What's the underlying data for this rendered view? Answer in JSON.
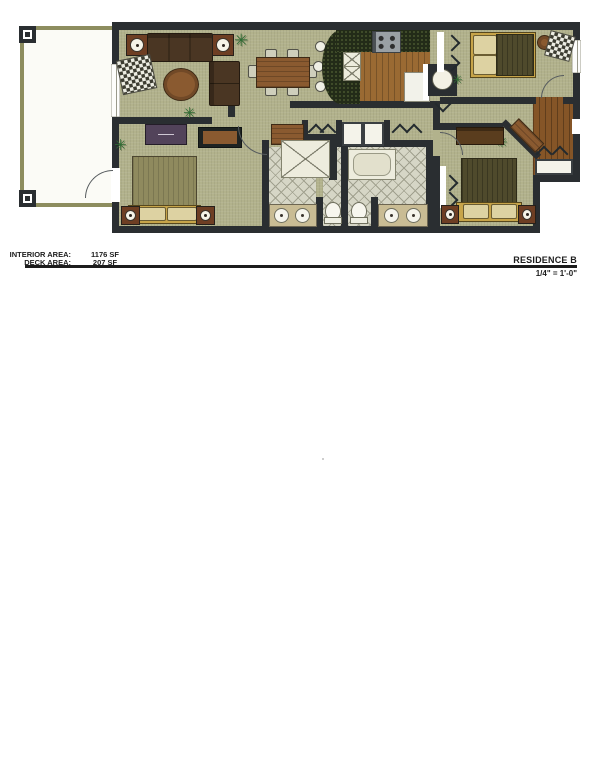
{
  "sheet": {
    "areas": [
      {
        "label": "INTERIOR AREA:",
        "value": "1176 SF"
      },
      {
        "label": "DECK AREA:",
        "value": "207 SF"
      }
    ],
    "title": "RESIDENCE B",
    "scale": "1/4\" = 1'-0\""
  },
  "icons": {
    "plant": "✳"
  },
  "colors": {
    "wall": "#2a2e31",
    "floor": "#b2b28c",
    "deckTrim": "#8d8d5f",
    "deckFloor": "#fbfbf6",
    "wood": "#855527",
    "woodLight": "#9a6a33",
    "counter": "#232b18",
    "tile": "#d6d6c6",
    "tileLine": "#a0a08e",
    "fixture": "#edecdd",
    "sofa": "#4a3623",
    "accent": "#6e3e23",
    "tableWood": "#8a5a30",
    "bedFrame": "#c7a449",
    "duvet": "#8f8a5e",
    "duvetDark": "#4f4a2c",
    "pillow": "#ddd2a2",
    "plant": "#2f6b33",
    "plum": "#52435a",
    "rugDark": "#3c3c31",
    "vanity": "#c9bc94"
  }
}
